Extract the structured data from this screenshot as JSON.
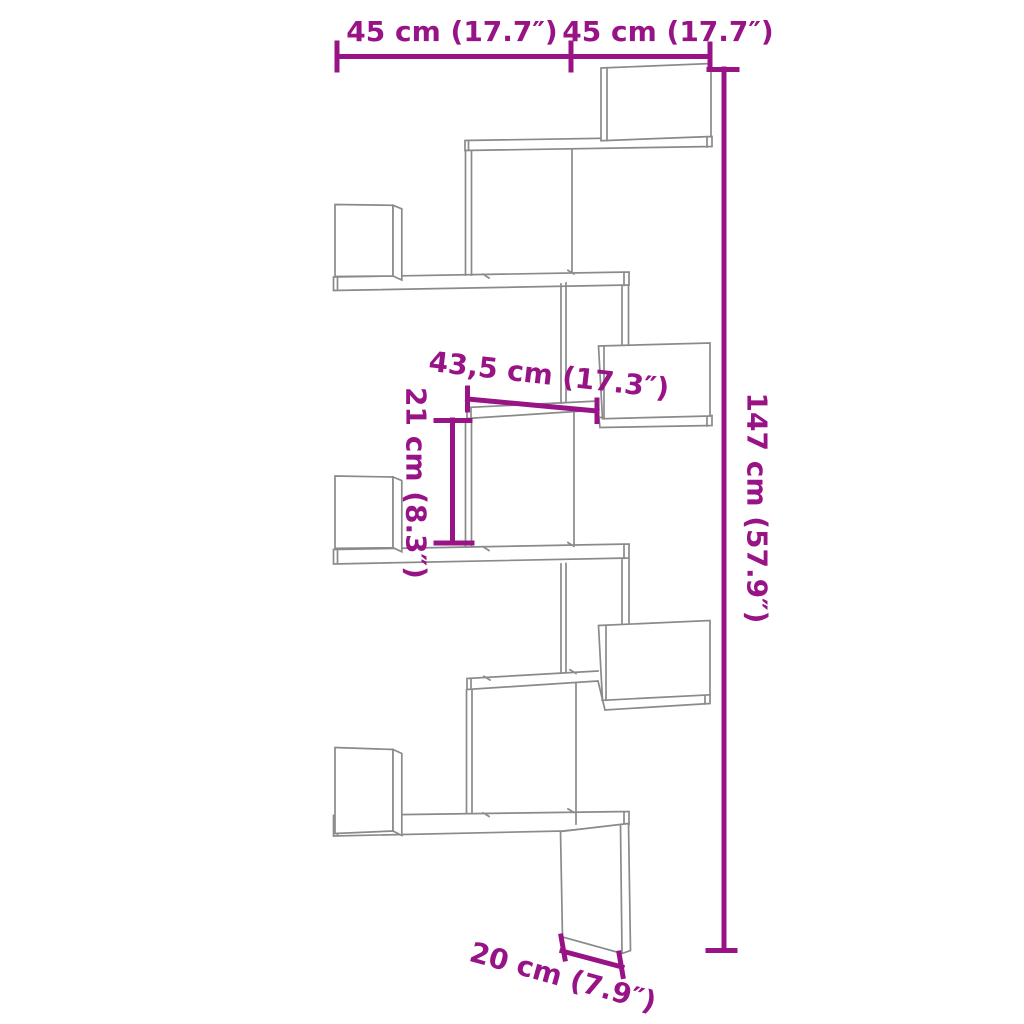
{
  "diagram": {
    "accent_color": "#981386",
    "line_color": "#8a8a8a",
    "background": "#ffffff",
    "dimensions": {
      "top_left_width": "45 cm (17.7″)",
      "top_right_width": "45 cm (17.7″)",
      "total_height": "147 cm (57.9″)",
      "shelf_width": "43,5 cm (17.3″)",
      "shelf_gap_height": "21 cm (8.3″)",
      "depth": "20 cm (7.9″)"
    }
  }
}
